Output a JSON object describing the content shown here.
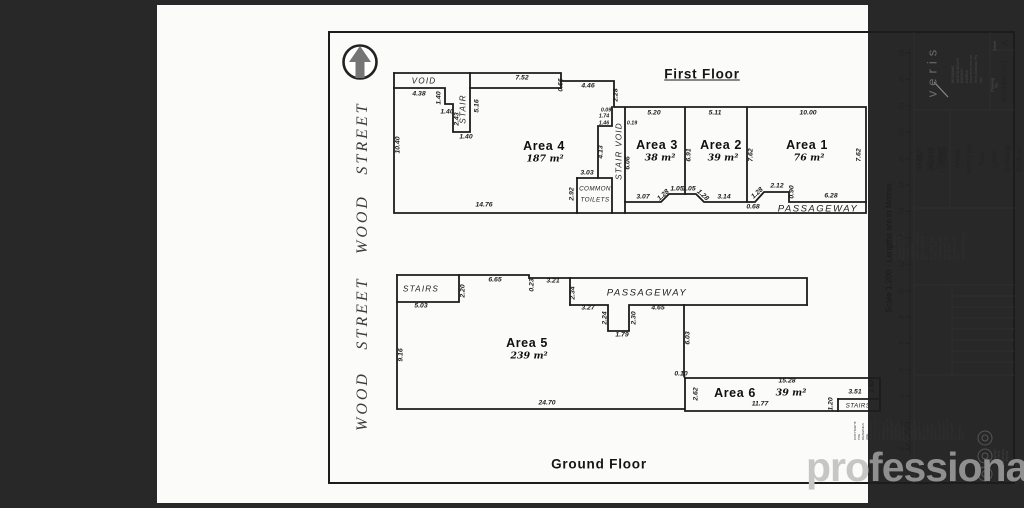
{
  "colors": {
    "backdrop": "#282828",
    "page": "#fbfbf9",
    "ink": "#1d1d1d",
    "watermark_light": "#c6c6c6",
    "watermark_dark": "#8f8f8f"
  },
  "watermark": {
    "left": "pro",
    "right": "fessionals"
  },
  "floor_titles": {
    "first": "First Floor",
    "ground": "Ground Floor"
  },
  "scale_bar": {
    "caption": "Scale 1:200 - Lengths are in Metres",
    "ticks": [
      "28",
      "26",
      "24",
      "22",
      "20",
      "18",
      "16",
      "14",
      "12",
      "10",
      "8",
      "6",
      "4",
      "2",
      "0",
      "2"
    ]
  },
  "title_block": {
    "logo": "veris",
    "contact_lines": [
      "BRISBANE   WHITSUNDAYS",
      "MACKAY      CAIRNS",
      "www.veris.com.au",
      "Veris Australia Pty Ltd"
    ],
    "sheet_label": "Sheet",
    "sheet": "A",
    "drawing_no_label": "Drawing No",
    "drawing_no": "400188LS01",
    "client": "11 Wood Street",
    "for_label": "FOR",
    "description_lines": [
      "Sketch Plan of Lettable",
      "Areas within the Two",
      "Level Building Built on",
      "Lot 1 on RP718052"
    ],
    "field_lines": [
      "Locality: Mackay",
      "Local Authority: Mackay Regional Council",
      "Horizontal Datum: Cadastral",
      "Scale: 1:200 at A4",
      "Surveyed: SRL",
      "Drawn: SJL",
      "Checked: SAS",
      "Plan Date: 13 Oct. 2016",
      "Computer File Ref: 400188LS01.dwg"
    ],
    "disclaimer_lines": [
      "COPYRIGHT: THE DRAWINGS ARE COPYRIGHT AND ARE NOT TO BE",
      "USED OR REPRODUCED WITHOUT THE WRITTEN PERMISSION OF VERIS.",
      "All measurements and areas are in accordance with",
      "the Property Council of Australia Method for the",
      "Measurement of Buildings (as at Copyright 1997,",
      "Reprinted 2008)."
    ],
    "important_lines": [
      "IMPORTANT - Lot 1(b):",
      "this plan was prepared as a sketch plan",
      "for the purposes of identifying lettable",
      "areas and is not to be used for any",
      "other purpose or relied upon by any",
      "other person or corporation."
    ],
    "copyright": "Copyright © Veris Australia Pty Ltd"
  },
  "plan_labels": [
    {
      "t": "VOID",
      "x": 267,
      "y": 76,
      "c": "name"
    },
    {
      "t": "7.52",
      "x": 365,
      "y": 74
    },
    {
      "t": "0.66",
      "x": 405,
      "y": 80,
      "r": -90
    },
    {
      "t": "4.46",
      "x": 431,
      "y": 82
    },
    {
      "t": "2.28",
      "x": 460,
      "y": 90,
      "r": -90
    },
    {
      "t": "4.38",
      "x": 262,
      "y": 90
    },
    {
      "t": "1.40",
      "x": 283,
      "y": 93,
      "r": -90
    },
    {
      "t": "1.40",
      "x": 290,
      "y": 108
    },
    {
      "t": "2.43",
      "x": 301,
      "y": 114,
      "r": -90
    },
    {
      "t": "1.40",
      "x": 309,
      "y": 133
    },
    {
      "t": "STAIR",
      "x": 306,
      "y": 104,
      "r": -90,
      "c": "name"
    },
    {
      "t": "5.16",
      "x": 321,
      "y": 101,
      "r": -90
    },
    {
      "t": "10.40",
      "x": 242,
      "y": 140,
      "r": -90
    },
    {
      "t": "Area 4",
      "x": 387,
      "y": 141,
      "c": "room"
    },
    {
      "t": "187 m²",
      "x": 388,
      "y": 154,
      "c": "area"
    },
    {
      "t": "14.76",
      "x": 327,
      "y": 201
    },
    {
      "t": "0.09",
      "x": 449,
      "y": 106,
      "c": "tiny"
    },
    {
      "t": "1.74",
      "x": 447,
      "y": 112,
      "c": "tiny"
    },
    {
      "t": "1.46",
      "x": 447,
      "y": 119,
      "c": "tiny"
    },
    {
      "t": "4.13",
      "x": 445,
      "y": 147,
      "r": -90
    },
    {
      "t": "STAIR VOID",
      "x": 462,
      "y": 146,
      "r": -90,
      "c": "name"
    },
    {
      "t": "3.03",
      "x": 430,
      "y": 169
    },
    {
      "t": "2.92",
      "x": 416,
      "y": 189,
      "r": -90
    },
    {
      "t": "COMMON",
      "x": 438,
      "y": 184,
      "c": "tname"
    },
    {
      "t": "TOILETS",
      "x": 438,
      "y": 195,
      "c": "tname"
    },
    {
      "t": "5.20",
      "x": 497,
      "y": 109
    },
    {
      "t": "0.19",
      "x": 475,
      "y": 119,
      "c": "tiny"
    },
    {
      "t": "6.06",
      "x": 472,
      "y": 158,
      "r": -90
    },
    {
      "t": "Area 3",
      "x": 500,
      "y": 140,
      "c": "room"
    },
    {
      "t": "38 m²",
      "x": 503,
      "y": 153,
      "c": "area"
    },
    {
      "t": "6.91",
      "x": 533,
      "y": 150,
      "r": -90
    },
    {
      "t": "5.11",
      "x": 558,
      "y": 109
    },
    {
      "t": "Area 2",
      "x": 564,
      "y": 140,
      "c": "room"
    },
    {
      "t": "39 m²",
      "x": 566,
      "y": 153,
      "c": "area"
    },
    {
      "t": "7.62",
      "x": 595,
      "y": 150,
      "r": -90
    },
    {
      "t": "10.00",
      "x": 651,
      "y": 109
    },
    {
      "t": "Area 1",
      "x": 650,
      "y": 140,
      "c": "room"
    },
    {
      "t": "76 m²",
      "x": 652,
      "y": 153,
      "c": "area"
    },
    {
      "t": "7.62",
      "x": 703,
      "y": 150,
      "r": -90
    },
    {
      "t": "3.07",
      "x": 486,
      "y": 193
    },
    {
      "t": "1.28",
      "x": 507,
      "y": 191,
      "r": -42
    },
    {
      "t": "1.05",
      "x": 520,
      "y": 185
    },
    {
      "t": "1.05",
      "x": 532,
      "y": 185
    },
    {
      "t": "1.28",
      "x": 545,
      "y": 191,
      "r": 42
    },
    {
      "t": "3.14",
      "x": 567,
      "y": 193
    },
    {
      "t": "0.68",
      "x": 596,
      "y": 203
    },
    {
      "t": "1.28",
      "x": 601,
      "y": 189,
      "r": -42
    },
    {
      "t": "2.12",
      "x": 620,
      "y": 182
    },
    {
      "t": "0.90",
      "x": 636,
      "y": 187,
      "r": -90
    },
    {
      "t": "6.28",
      "x": 674,
      "y": 192
    },
    {
      "t": "PASSAGEWAY",
      "x": 661,
      "y": 204,
      "c": "name9"
    },
    {
      "t": "STAIRS",
      "x": 264,
      "y": 284,
      "c": "name"
    },
    {
      "t": "2.20",
      "x": 307,
      "y": 286,
      "r": -90
    },
    {
      "t": "6.65",
      "x": 338,
      "y": 276
    },
    {
      "t": "0.23",
      "x": 376,
      "y": 280,
      "r": -90
    },
    {
      "t": "3.21",
      "x": 396,
      "y": 277
    },
    {
      "t": "2.34",
      "x": 417,
      "y": 288,
      "r": -90
    },
    {
      "t": "PASSAGEWAY",
      "x": 490,
      "y": 288,
      "c": "name9"
    },
    {
      "t": "5.03",
      "x": 264,
      "y": 302
    },
    {
      "t": "3.27",
      "x": 431,
      "y": 304
    },
    {
      "t": "2.24",
      "x": 449,
      "y": 313,
      "r": -90
    },
    {
      "t": "1.79",
      "x": 465,
      "y": 331
    },
    {
      "t": "2.30",
      "x": 478,
      "y": 313,
      "r": -90
    },
    {
      "t": "4.65",
      "x": 501,
      "y": 304
    },
    {
      "t": "6.03",
      "x": 532,
      "y": 333,
      "r": -90
    },
    {
      "t": "Area 5",
      "x": 370,
      "y": 338,
      "c": "room"
    },
    {
      "t": "239 m²",
      "x": 372,
      "y": 351,
      "c": "area"
    },
    {
      "t": "9.16",
      "x": 245,
      "y": 350,
      "r": -90
    },
    {
      "t": "24.70",
      "x": 390,
      "y": 399
    },
    {
      "t": "0.10",
      "x": 524,
      "y": 370
    },
    {
      "t": "2.62",
      "x": 540,
      "y": 389,
      "r": -90
    },
    {
      "t": "Area 6",
      "x": 578,
      "y": 388,
      "c": "room"
    },
    {
      "t": "15.28",
      "x": 630,
      "y": 377
    },
    {
      "t": "39 m²",
      "x": 634,
      "y": 388,
      "c": "area"
    },
    {
      "t": "11.77",
      "x": 603,
      "y": 400
    },
    {
      "t": "1.20",
      "x": 675,
      "y": 399,
      "r": -90
    },
    {
      "t": "3.51",
      "x": 698,
      "y": 388
    },
    {
      "t": "1.62",
      "x": 716,
      "y": 381,
      "r": -90
    },
    {
      "t": "STAIRS",
      "x": 701,
      "y": 401,
      "c": "tname"
    },
    {
      "t": "STREET",
      "x": 206,
      "y": 133,
      "r": -90,
      "c": "street"
    },
    {
      "t": "WOOD",
      "x": 206,
      "y": 219,
      "r": -90,
      "c": "street"
    },
    {
      "t": "STREET",
      "x": 206,
      "y": 308,
      "r": -90,
      "c": "street"
    },
    {
      "t": "WOOD",
      "x": 206,
      "y": 396,
      "r": -90,
      "c": "street"
    }
  ]
}
